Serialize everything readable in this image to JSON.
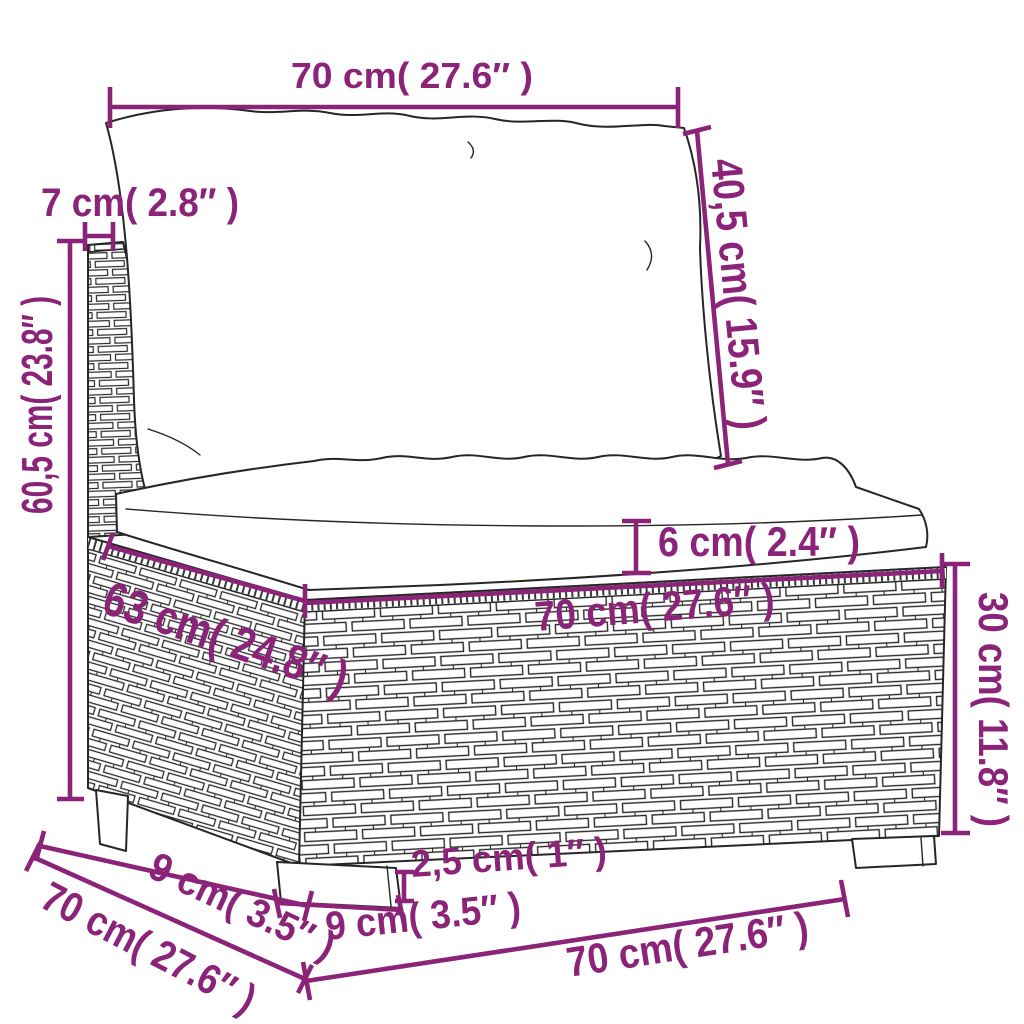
{
  "diagram": {
    "kind": "furniture-dimension-drawing",
    "subject": "poly-rattan middle sofa section with back and seat cushions",
    "accent_color": "#8B2478",
    "outline_color": "#262626",
    "background_color": "#ffffff",
    "dimensions": {
      "back_cushion_width": "70 cm( 27.6″ )",
      "back_panel_thickness": "7 cm( 2.8″ )",
      "back_cushion_height": "40,5 cm( 15.9″ )",
      "overall_height": "60,5 cm( 23.8″ )",
      "seat_top_depth": "63 cm( 24.8″ )",
      "seat_cushion_thickness": "6 cm( 2.4″ )",
      "seat_top_width": "70 cm( 27.6″ )",
      "base_height": "30 cm( 11.8″ )",
      "side_leg_inset": "9 cm( 3.5″ )",
      "overall_depth": "70 cm( 27.6″ )",
      "leg_height": "2,5 cm( 1″ )",
      "front_leg_width": "9 cm( 3.5″ )",
      "overall_width": "70 cm( 27.6″ )"
    }
  }
}
